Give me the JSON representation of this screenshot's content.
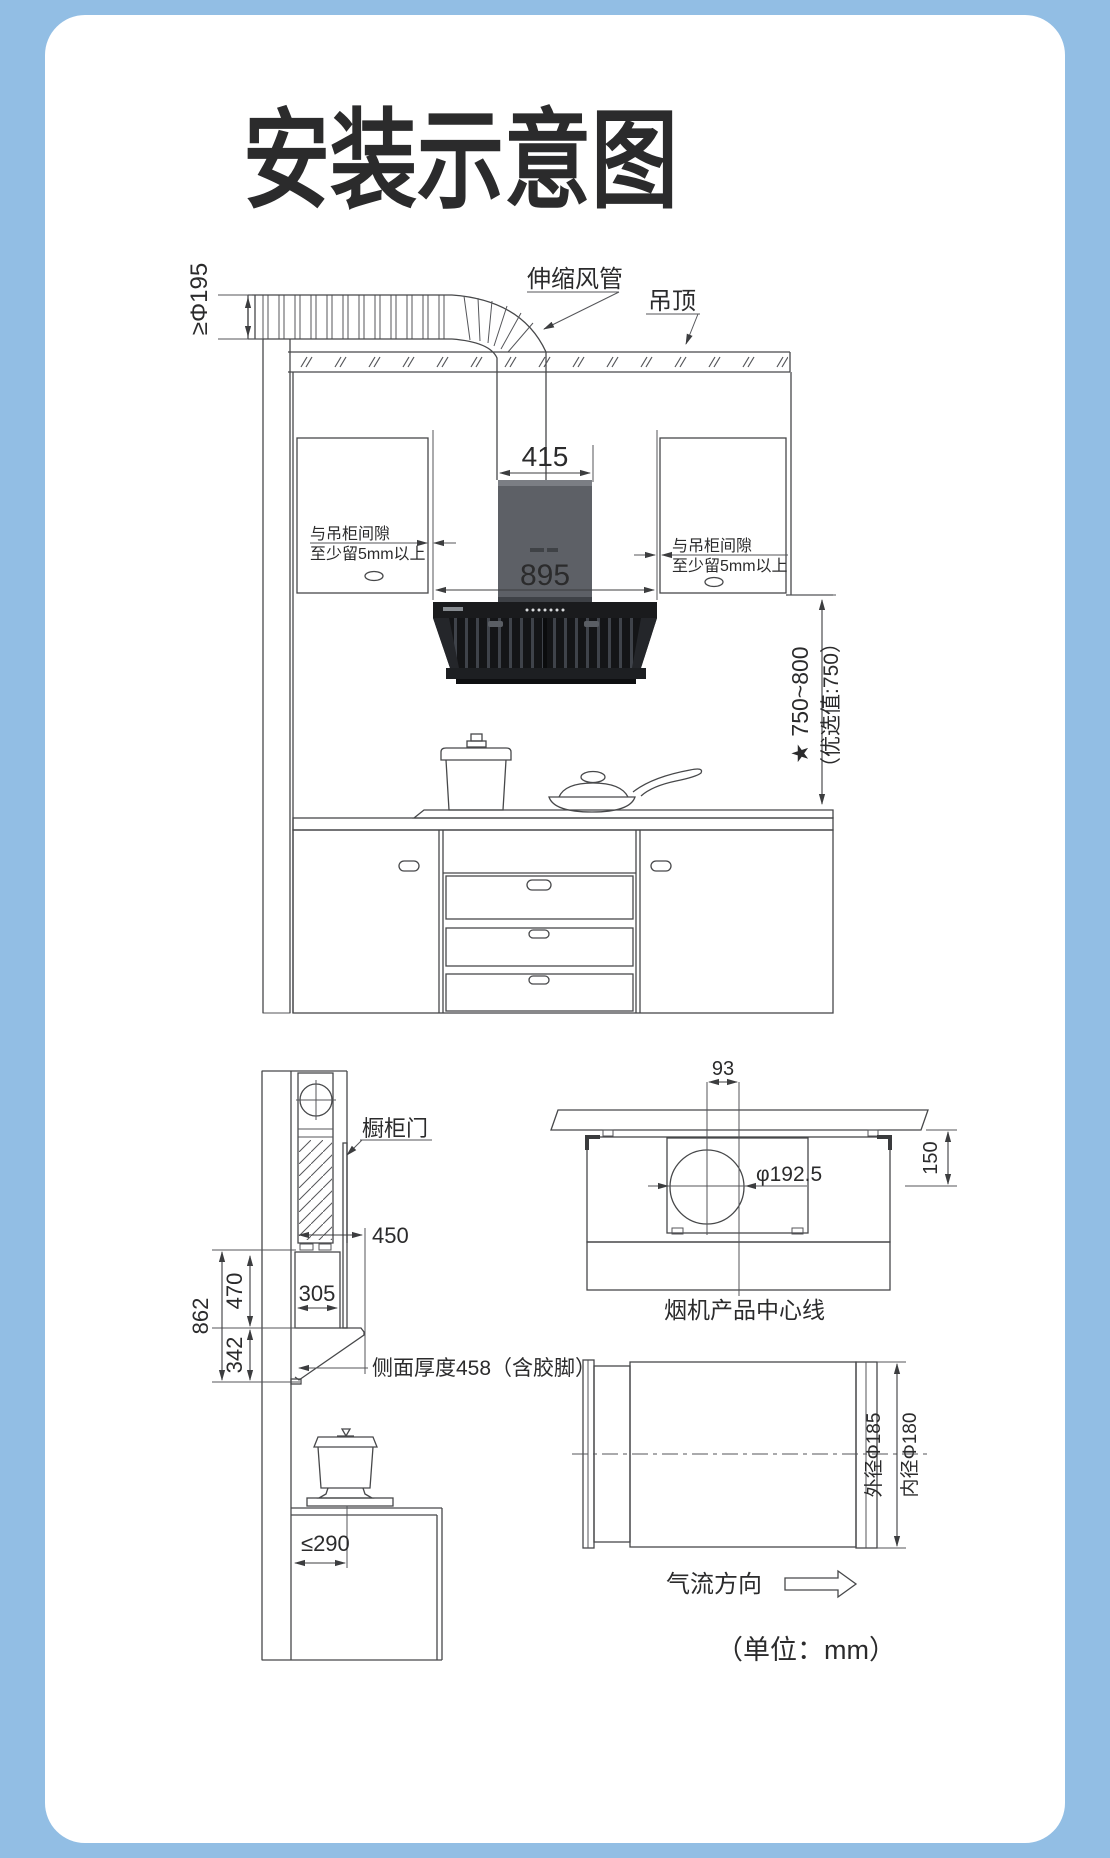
{
  "colors": {
    "background": "#92bee4",
    "card": "#ffffff",
    "line": "#47484a",
    "text": "#2b2b2c",
    "hood_chimney": "#5d6066",
    "hood_panel": "#1a1b1d",
    "hood_canopy": "#141517",
    "hood_width_text": "#4f4b47"
  },
  "title": "安装示意图",
  "main_view": {
    "duct_label": "伸缩风管",
    "ceiling_label": "吊顶",
    "duct_diameter_label": "≥Φ195",
    "chimney_width": "415",
    "hood_width": "895",
    "left_gap_line1": "与吊柜间隙",
    "left_gap_line2": "至少留5mm以上",
    "right_gap_line1": "与吊柜间隙",
    "right_gap_line2": "至少留5mm以上",
    "install_height": "★ 750~800",
    "install_height_note": "（优选值:750）"
  },
  "side_view": {
    "cabinet_door_label": "橱柜门",
    "top_depth": "450",
    "body_depth": "305",
    "body_height": "470",
    "lower_height": "342",
    "total_height": "862",
    "side_thickness_label": "侧面厚度458（含胶脚）",
    "stove_distance": "≤290"
  },
  "plan_view": {
    "center_offset": "93",
    "hole_diameter": "φ192.5",
    "hole_setback": "150",
    "centerline_label": "烟机产品中心线"
  },
  "duct_view": {
    "outer_diameter": "外径Φ185",
    "inner_diameter": "内径Φ180",
    "airflow_label": "气流方向",
    "unit_label": "（单位：mm）"
  }
}
